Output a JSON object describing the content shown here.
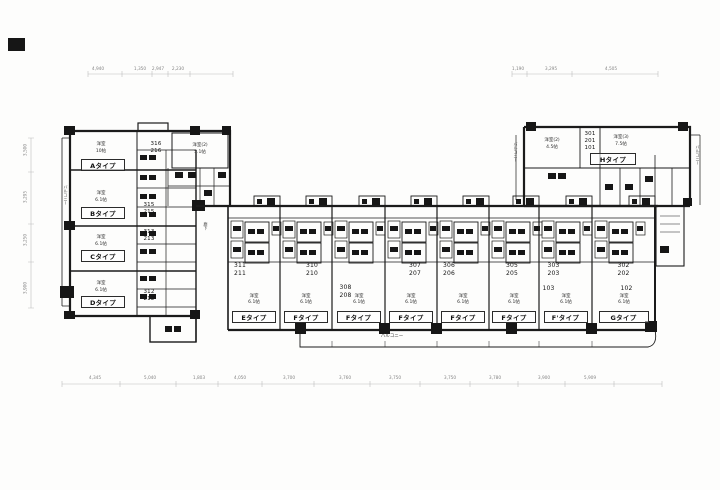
{
  "plan": {
    "balcony_label": "バルコニー",
    "corridor_label": "廊下",
    "colors": {
      "ink": "#1b1b1b",
      "paper": "#fdfdfc",
      "dim_text": "#878787"
    }
  },
  "dimensions": {
    "top": [
      "4,940",
      "1,350",
      "2,947",
      "2,230",
      "1,190",
      "3,295",
      "4,505"
    ],
    "bottom": [
      "4,345",
      "5,040",
      "1,803",
      "4,050",
      "3,700",
      "3,760",
      "3,750",
      "3,750",
      "3,780",
      "3,900",
      "5,909"
    ],
    "left": [
      "3,500",
      "3,295",
      "3,250",
      "3,900"
    ]
  },
  "left_wing": {
    "upper_room": {
      "name": "洋室(2)",
      "size": "5.1帖"
    },
    "units": [
      {
        "type": "Aタイプ",
        "room": "洋室",
        "size": "10帖",
        "num3": "316",
        "num2": "216"
      },
      {
        "type": "Bタイプ",
        "room": "洋室",
        "size": "6.1帖",
        "num3": "315",
        "num2": "215"
      },
      {
        "type": "Cタイプ",
        "room": "洋室",
        "size": "6.1帖",
        "num3": "313",
        "num2": "213"
      },
      {
        "type": "Dタイプ",
        "room": "洋室",
        "size": "6.1帖",
        "num3": "312",
        "num2": "212"
      }
    ]
  },
  "middle_wing": {
    "units": [
      {
        "type": "Eタイプ",
        "room": "洋室",
        "size": "6.1帖",
        "num3": "311",
        "num2": "211"
      },
      {
        "type": "Fタイプ",
        "room": "洋室",
        "size": "6.1帖",
        "num3": "310",
        "num2": "210"
      },
      {
        "type": "Fタイプ",
        "room": "洋室",
        "size": "6.1帖",
        "num3": "308",
        "num2": "208"
      },
      {
        "type": "Fタイプ",
        "room": "洋室",
        "size": "6.1帖",
        "num3": "307",
        "num2": "207"
      },
      {
        "type": "Fタイプ",
        "room": "洋室",
        "size": "6.1帖",
        "num3": "306",
        "num2": "206"
      },
      {
        "type": "Fタイプ",
        "room": "洋室",
        "size": "6.1帖",
        "num3": "305",
        "num2": "205"
      },
      {
        "type": "F'タイプ",
        "room": "洋室",
        "size": "6.1帖",
        "num3": "303",
        "num2": "203",
        "num1": "103"
      },
      {
        "type": "Gタイプ",
        "room": "洋室",
        "size": "6.1帖",
        "num3": "302",
        "num2": "202",
        "num1": "102"
      }
    ]
  },
  "right_wing": {
    "type": "Hタイプ",
    "num3": "301",
    "num2": "201",
    "num1": "101",
    "room2": {
      "name": "洋室(2)",
      "size": "4.5帖"
    },
    "room3": {
      "name": "洋室(3)",
      "size": "7.5帖"
    }
  }
}
